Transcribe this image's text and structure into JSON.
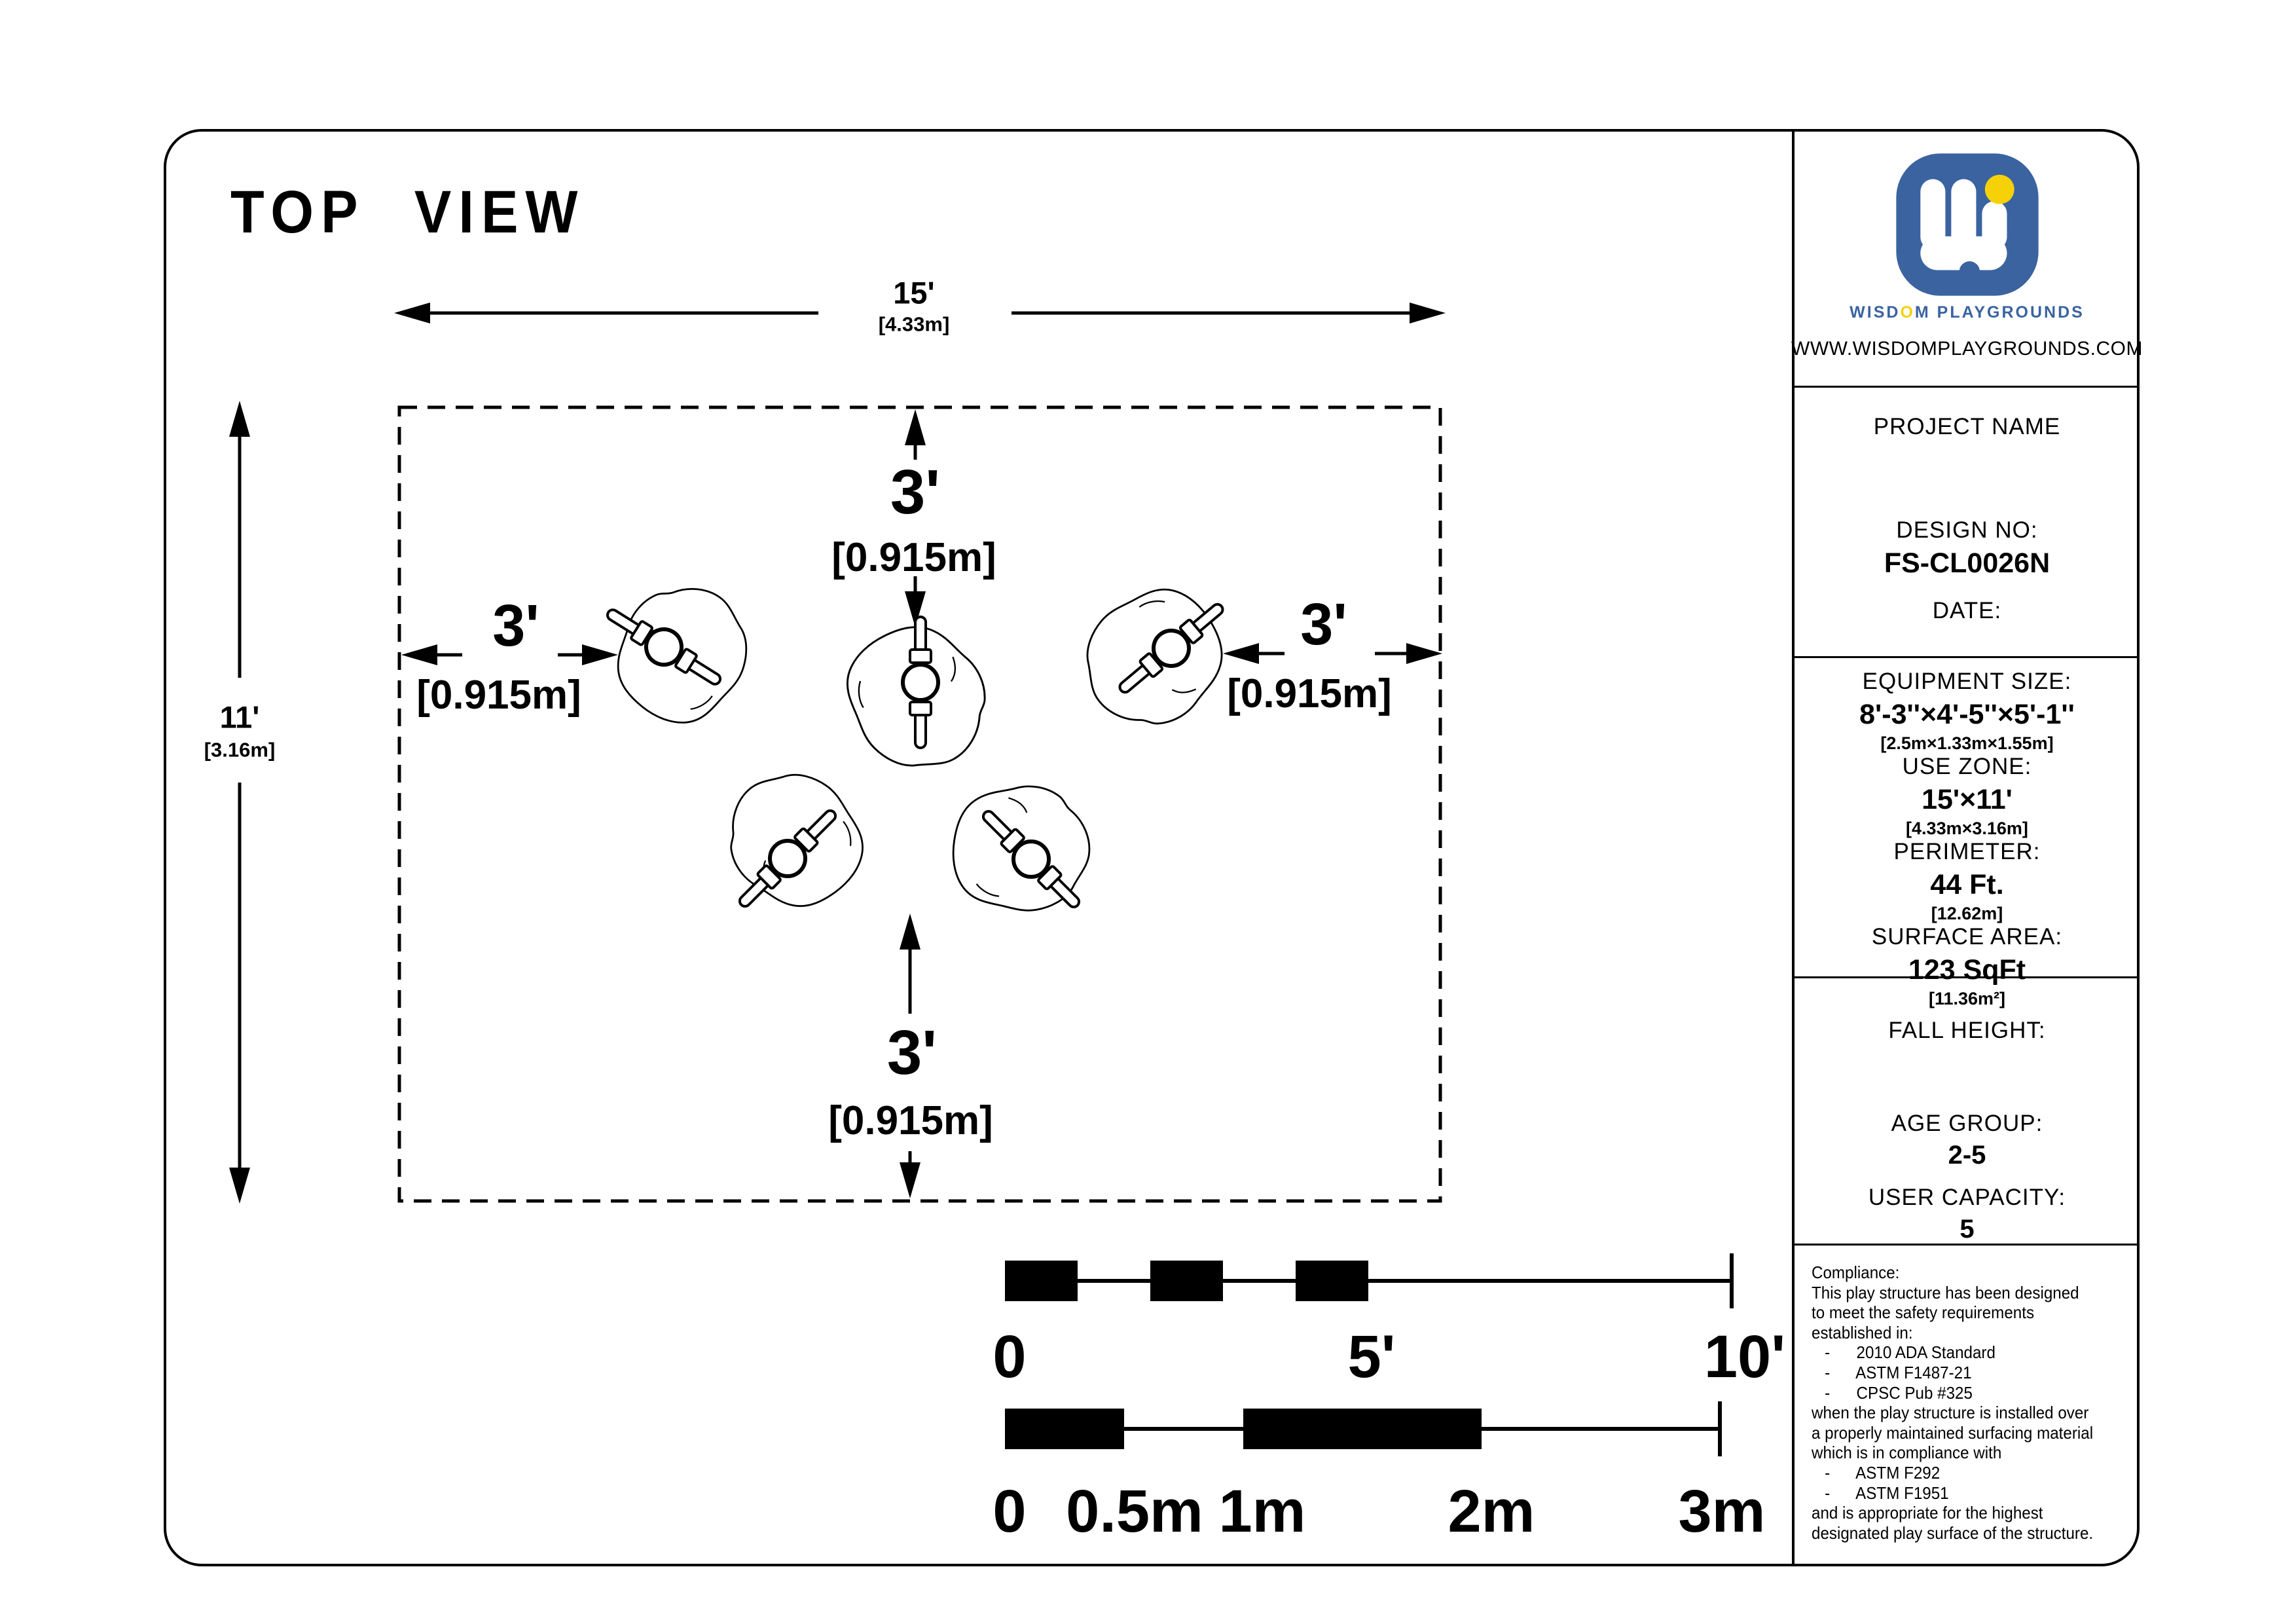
{
  "title": "TOP VIEW",
  "drawing": {
    "dim_width": {
      "feet": "15'",
      "meters": "[4.33m]"
    },
    "dim_height": {
      "feet": "11'",
      "meters": "[3.16m]"
    },
    "clearances": {
      "top": {
        "feet": "3'",
        "meters": "[0.915m]"
      },
      "left": {
        "feet": "3'",
        "meters": "[0.915m]"
      },
      "right": {
        "feet": "3'",
        "meters": "[0.915m]"
      },
      "bottom": {
        "feet": "3'",
        "meters": "[0.915m]"
      }
    },
    "scale_feet": {
      "labels": [
        "0",
        "5'",
        "10'"
      ]
    },
    "scale_meters": {
      "labels": [
        "0",
        "0.5m",
        "1m",
        "2m",
        "3m"
      ]
    }
  },
  "sidebar": {
    "logo": {
      "brand_pre": "WISD",
      "brand_o": "O",
      "brand_post": "M  PLAYGROUNDS",
      "website": "WWW.WISDOMPLAYGROUNDS.COM",
      "blue": "#3a63a0",
      "yellow": "#f7d108"
    },
    "project": {
      "name_label": "PROJECT NAME",
      "design_label": "DESIGN NO:",
      "design_value": "FS-CL0026N",
      "date_label": "DATE:"
    },
    "specs": [
      {
        "label": "EQUIPMENT SIZE:",
        "value": "8'-3''×4'-5''×5'-1''",
        "metric": "[2.5m×1.33m×1.55m]"
      },
      {
        "label": "USE ZONE:",
        "value": "15'×11'",
        "metric": "[4.33m×3.16m]"
      },
      {
        "label": "PERIMETER:",
        "value": "44 Ft.",
        "metric": "[12.62m]"
      },
      {
        "label": "SURFACE AREA:",
        "value": "123 SqFt",
        "metric": "[11.36m²]"
      }
    ],
    "safety": {
      "fall_label": "FALL HEIGHT:",
      "age_label": "AGE GROUP:",
      "age_value": "2-5",
      "capacity_label": "USER CAPACITY:",
      "capacity_value": "5"
    },
    "compliance": {
      "lines": [
        "Compliance:",
        "This play structure has been designed",
        "to meet the safety requirements",
        "established in:",
        "   -      2010 ADA Standard",
        "   -      ASTM F1487-21",
        "   -      CPSC Pub #325",
        "when the play structure is installed over",
        "a properly maintained surfacing material",
        "which is in compliance with",
        "   -      ASTM F292",
        "   -      ASTM F1951",
        "and is appropriate for the highest",
        "designated play surface of the structure."
      ]
    }
  }
}
